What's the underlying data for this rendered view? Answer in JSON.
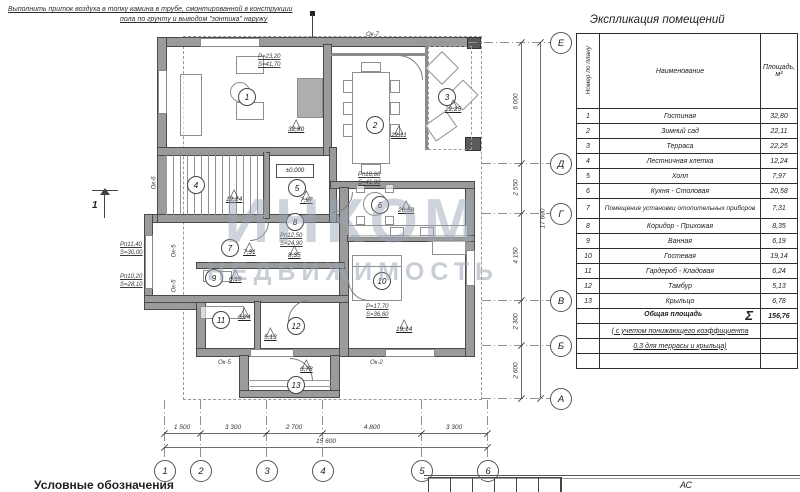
{
  "colors": {
    "ink": "#3a3a3a",
    "wall_fill": "#9b9b9b",
    "watermark": "#9ba6b5"
  },
  "annotation": {
    "line1": "Выполнить приток воздуха в топку камина в трубе, смонтированной в конструкции",
    "line2": "пола по грунту и выводом \"зонтика\" наружу"
  },
  "watermark": {
    "line1": "ИНКОМ",
    "line2": "НЕДВИЖИМОСТЬ"
  },
  "schedule": {
    "title": "Экспликация помещений",
    "col_num": "Номер по плану",
    "col_name": "Наименование",
    "col_area": "Площадь, м²",
    "rows": [
      {
        "num": "1",
        "name": "Гостиная",
        "area": "32,80"
      },
      {
        "num": "2",
        "name": "Зимний сад",
        "area": "22,11"
      },
      {
        "num": "3",
        "name": "Терраса",
        "area": "22,25"
      },
      {
        "num": "4",
        "name": "Лестничная клетка",
        "area": "12,24"
      },
      {
        "num": "5",
        "name": "Холл",
        "area": "7,97"
      },
      {
        "num": "6",
        "name": "Кухня - Столовая",
        "area": "20,58"
      },
      {
        "num": "7",
        "name": "Помещение установки отопительных приборов",
        "area": "7,31"
      },
      {
        "num": "8",
        "name": "Коридор - Прихожая",
        "area": "8,35"
      },
      {
        "num": "9",
        "name": "Ванная",
        "area": "6,19"
      },
      {
        "num": "10",
        "name": "Гостевая",
        "area": "19,14"
      },
      {
        "num": "11",
        "name": "Гардероб - Кладовая",
        "area": "6,24"
      },
      {
        "num": "12",
        "name": "Тамбур",
        "area": "5,13"
      },
      {
        "num": "13",
        "name": "Крыльцо",
        "area": "6,78"
      }
    ],
    "total_label": "Общая площадь",
    "total_sigma": "Σ",
    "total_value": "156,76",
    "note1": "( с учетом понижающего коэффициента",
    "note2": "0,3 для террасы и крыльца)"
  },
  "axes": {
    "vertical": [
      "Е",
      "Д",
      "Г",
      "В",
      "Б",
      "А"
    ],
    "horizontal": [
      "1",
      "2",
      "3",
      "4",
      "5",
      "6"
    ],
    "v_dims": [
      "6 000",
      "2 550",
      "4 150",
      "2 300",
      "2 600"
    ],
    "v_total": "17 600",
    "h_dims": [
      "1 500",
      "3 300",
      "2 700",
      "4 800",
      "3 300"
    ],
    "h_total": "15 600"
  },
  "plan": {
    "level_mark": "±0.000",
    "section_mark": "1",
    "rooms": [
      {
        "num": "1",
        "area": "32,80"
      },
      {
        "num": "2",
        "area": "22,11"
      },
      {
        "num": "3",
        "area": "22,25"
      },
      {
        "num": "4",
        "area": "12,24"
      },
      {
        "num": "5",
        "area": "7,97"
      },
      {
        "num": "6",
        "area": "20,58"
      },
      {
        "num": "7",
        "area": "7,31"
      },
      {
        "num": "8",
        "area": "8,35"
      },
      {
        "num": "9",
        "area": "6,19"
      },
      {
        "num": "10",
        "area": "19,14"
      },
      {
        "num": "11",
        "area": "6,24"
      },
      {
        "num": "12",
        "area": "5,13"
      },
      {
        "num": "13",
        "area": "6,78"
      }
    ],
    "peri_labels": [
      {
        "l1": "Р=23,20",
        "l2": "S=41,70"
      },
      {
        "l1": "Рп18,60",
        "l2": "S=41,90"
      },
      {
        "l1": "Рп12,50",
        "l2": "S=24,90"
      },
      {
        "l1": "Р=17,70",
        "l2": "S=36,60"
      },
      {
        "l1": "Рп11,40",
        "l2": "S=30,00"
      },
      {
        "l1": "Рп10,20",
        "l2": "S=28,10"
      }
    ],
    "window_tags": [
      "Ок-7",
      "Ок-6",
      "Ок-5",
      "Ок-5",
      "Ок-5",
      "Ок-2"
    ]
  },
  "legend_title": "Условные обозначения",
  "titleblock": {
    "code": "АС"
  }
}
